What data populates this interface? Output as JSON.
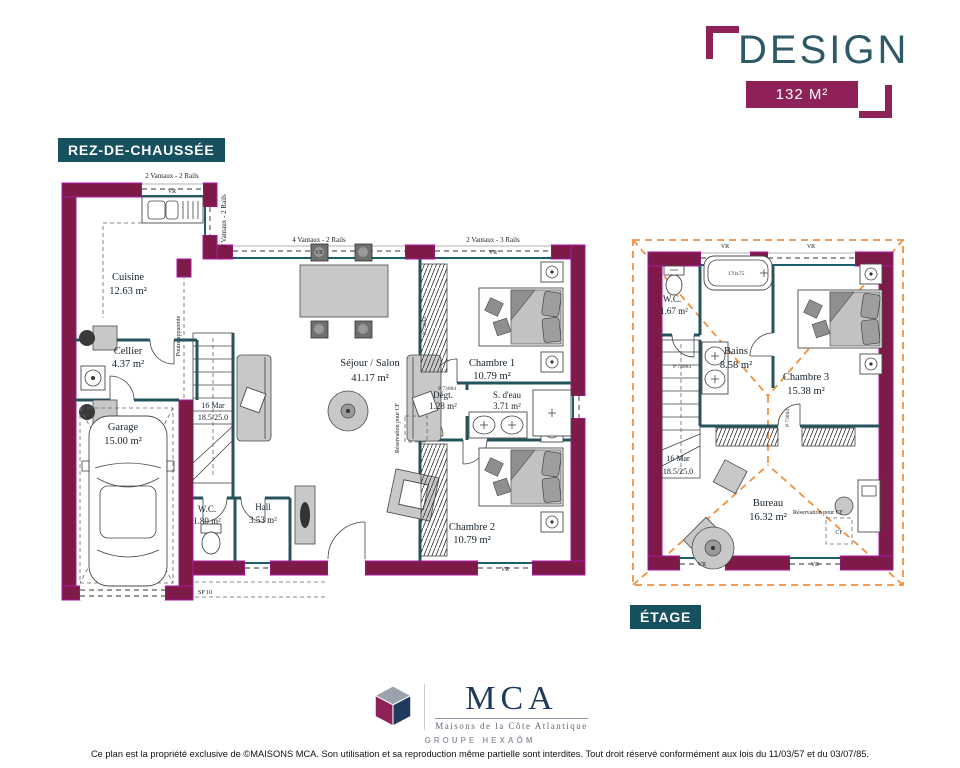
{
  "header": {
    "title": "DESIGN",
    "area_badge": "132 M²"
  },
  "section_labels": {
    "ground": "REZ-DE-CHAUSSÉE",
    "upper": "ÉTAGE"
  },
  "ground": {
    "rooms": [
      {
        "name": "Cuisine",
        "area": "12.63 m²"
      },
      {
        "name": "Cellier",
        "area": "4.37 m²"
      },
      {
        "name": "Garage",
        "area": "15.00 m²"
      },
      {
        "name": "Séjour / Salon",
        "area": "41.17 m²"
      },
      {
        "name": "Chambre 1",
        "area": "10.79 m²"
      },
      {
        "name": "Dégt.",
        "area": "1.28 m²"
      },
      {
        "name": "S. d'eau",
        "area": "3.71 m²"
      },
      {
        "name": "Chambre 2",
        "area": "10.79 m²"
      },
      {
        "name": "W.C.",
        "area": "1.80 m²"
      },
      {
        "name": "Hall",
        "area": "3.53 m²"
      }
    ],
    "stairs": {
      "label": "16 Mar",
      "dims": "18.5/25.0"
    },
    "windows": {
      "two_rails": "2 Vantaux - 2 Rails",
      "four_rails": "4 Vantaux - 2 Rails",
      "three_rails": "2 Vantaux - 3 Rails",
      "vr": "VR"
    },
    "annotations": {
      "beam": "Poutre apparente",
      "entry": "SP 10"
    }
  },
  "upper": {
    "rooms": [
      {
        "name": "W.C.",
        "area": "1.67 m²"
      },
      {
        "name": "Bains",
        "area": "8.58 m²"
      },
      {
        "name": "Chambre 3",
        "area": "15.38 m²"
      },
      {
        "name": "Bureau",
        "area": "16.32 m²"
      }
    ],
    "stairs": {
      "label": "16 Mar",
      "dims": "18.5/25.0"
    },
    "bath_size": "170x75",
    "cf": "CF",
    "vr": "VR"
  },
  "plan_refs": {
    "door": "P 73084",
    "reservation": "Réservation pour CF"
  },
  "footer": {
    "brand": "MCA",
    "brand_subtitle": "Maisons de la Côte Atlantique",
    "brand_group": "GROUPE HEXAÔM",
    "copyright": "Ce plan est la propriété exclusive de ©MAISONS MCA. Son utilisation et sa reproduction même partielle sont interdites. Tout droit réservé conformément aux lois du 11/03/57 et du 03/07/85."
  },
  "colors": {
    "wall_fill": "#7e1a47",
    "wall_edge": "#aa17a5",
    "partition_teal": "#24535e",
    "sill_teal": "#1a5f6b",
    "roof_dash_orange": "#f0903f",
    "label_teal_bg": "#17505f",
    "brand_maroon": "#8e2158",
    "title_teal": "#2e5a68",
    "brand_navy": "#1e3a5c"
  }
}
